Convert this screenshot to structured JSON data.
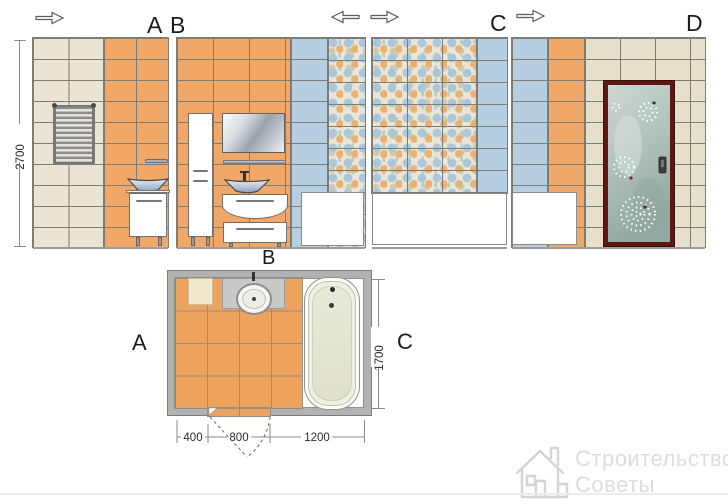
{
  "colors": {
    "tile_beige": "#eae5d2",
    "tile_beige_dark": "#e7e0cc",
    "tile_orange": "#f0a767",
    "tile_blue": "#b5cee1",
    "mosaic_base": "#e9e5d8",
    "grout": "#7d7d75",
    "wall_gray": "#b2b2b2",
    "floor_orange": "#eda25e",
    "door_frame": "#5b1912",
    "watermark_gray": "#dcdcdc"
  },
  "elevation_views": {
    "height_dimension_mm": "2700",
    "panels": [
      {
        "label": "A"
      },
      {
        "label": "B"
      },
      {
        "label": "C"
      },
      {
        "label": "D"
      }
    ],
    "direction_arrows": [
      "right",
      "left",
      "right",
      "right"
    ]
  },
  "floor_plan": {
    "label_top": "B",
    "label_left": "A",
    "label_right": "C",
    "width_segments_mm": [
      "400",
      "800",
      "1200"
    ],
    "depth_mm": "1700"
  },
  "watermark": {
    "title": "Строительство",
    "subtitle": "Советы"
  }
}
